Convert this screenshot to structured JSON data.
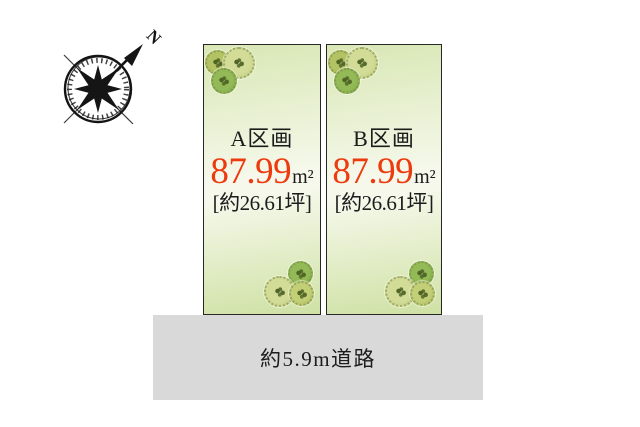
{
  "compass": {
    "north_label": "N"
  },
  "plots": [
    {
      "name": "A区画",
      "area_value": "87.99",
      "area_unit": "m²",
      "tsubo_label": "[約26.61坪]"
    },
    {
      "name": "B区画",
      "area_value": "87.99",
      "area_unit": "m²",
      "tsubo_label": "[約26.61坪]"
    }
  ],
  "road": {
    "label": "約5.9m道路"
  },
  "colors": {
    "page_bg": "#ffffff",
    "text_color": "#1c1c1c",
    "area_accent": "#ed3a0e",
    "plot_border": "#272727",
    "plot_grad_a": "#d8e7b4",
    "plot_grad_b": "#f5f8ea",
    "plot_grad_c": "#cfe1a4",
    "road_bg": "#d9d9d9",
    "tree_olive": "#b3c263",
    "tree_pale": "#d2dc97",
    "tree_green": "#93ba56",
    "tree_yellow": "#c3cf77"
  }
}
